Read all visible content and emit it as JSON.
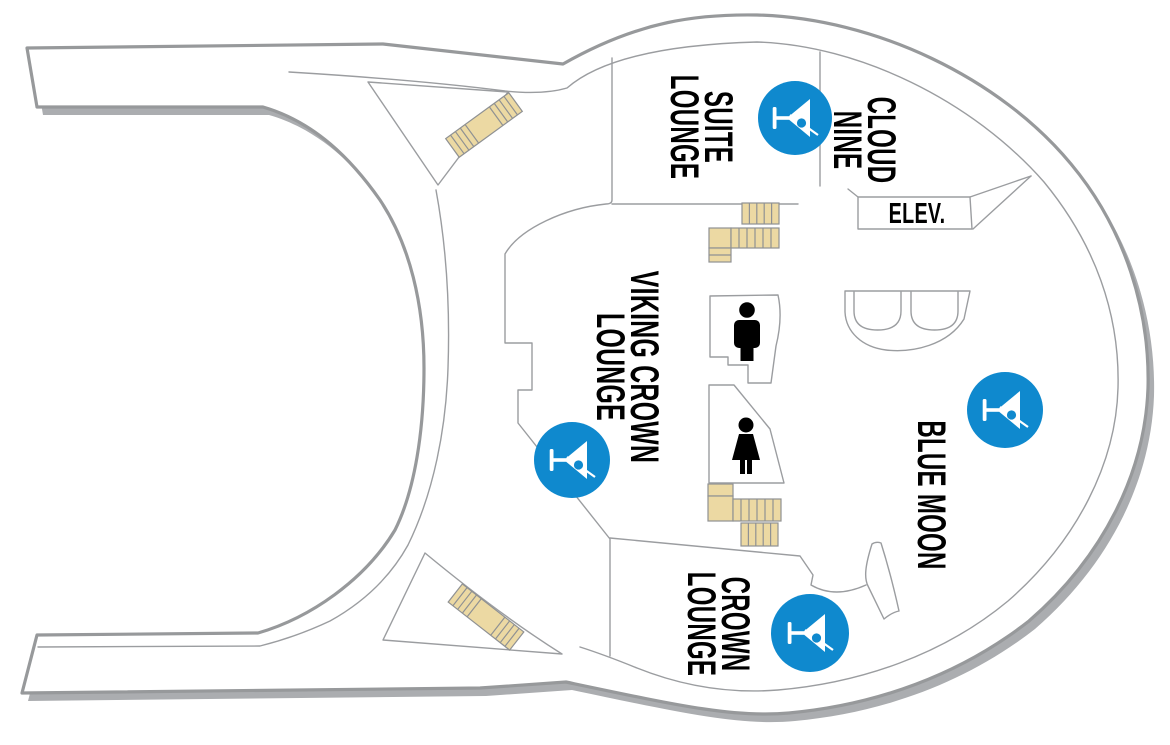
{
  "venues": {
    "suite_lounge": {
      "line1": "SUITE",
      "line2": "LOUNGE"
    },
    "cloud_nine": {
      "line1": "CLOUD",
      "line2": "NINE"
    },
    "viking_crown_lounge": {
      "line1": "VIKING CROWN",
      "line2": "LOUNGE"
    },
    "blue_moon": {
      "line1": "BLUE MOON"
    },
    "crown_lounge": {
      "line1": "CROWN",
      "line2": "LOUNGE"
    },
    "elevator": {
      "label": "ELEV."
    }
  },
  "icons": {
    "bar_icon": "martini-glass",
    "mens_restroom_icon": "man-silhouette",
    "womens_restroom_icon": "woman-silhouette",
    "stairs_marker": "stairs"
  },
  "colors": {
    "bar_icon_blue": "#0F89CE",
    "stairs_tan": "#ECD9A3",
    "deck_outline_gray": "#97999B",
    "interior_line_gray": "#9B9DA0",
    "shadow_gray": "#ABADB0",
    "deck_fill_white": "#FFFFFF",
    "label_black": "#000000"
  }
}
